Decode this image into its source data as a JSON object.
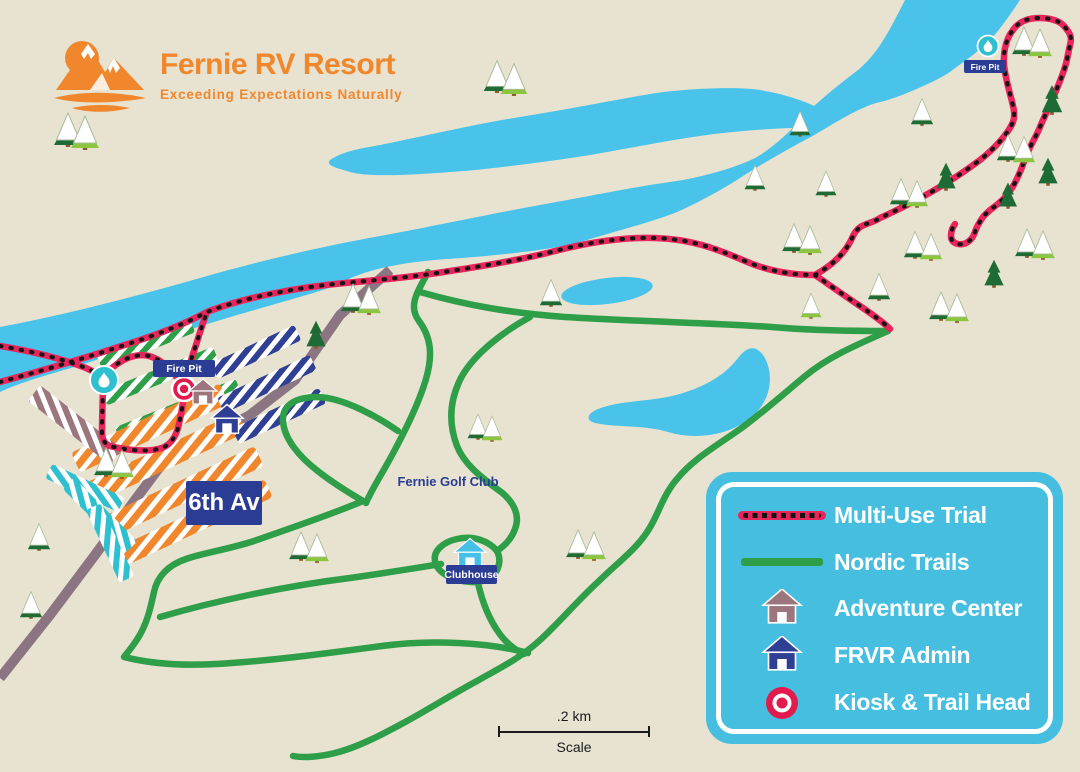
{
  "logo": {
    "title": "Fernie RV Resort",
    "tagline": "Exceeding Expectations Naturally"
  },
  "map_labels": {
    "fire_pit_left": "Fire Pit",
    "fire_pit_right": "Fire Pit",
    "street": "6th Av",
    "golf_club": "Fernie Golf Club",
    "clubhouse": "Clubhouse"
  },
  "scale_bar": {
    "distance": ".2 km",
    "label": "Scale"
  },
  "legend": {
    "items": [
      {
        "id": "multi-use-trail",
        "label": "Multi-Use Trial",
        "swatch": "dashed-line",
        "color": "#e8255b"
      },
      {
        "id": "nordic-trails",
        "label": "Nordic Trails",
        "swatch": "line",
        "color": "#2f9e48"
      },
      {
        "id": "adventure-center",
        "label": "Adventure Center",
        "swatch": "house",
        "color": "#9b777d"
      },
      {
        "id": "frvr-admin",
        "label": "FRVR Admin",
        "swatch": "house",
        "color": "#2e3f94"
      },
      {
        "id": "kiosk-trail-head",
        "label": "Kiosk & Trail Head",
        "swatch": "ring",
        "color": "#e31b4c"
      }
    ]
  },
  "colors": {
    "background": "#e8e2d0",
    "river": "#4ac3ea",
    "nordic_trail": "#2f9e48",
    "multi_use_trail": "#e8255b",
    "trail_dash": "#151515",
    "road": "#8b7583",
    "legend_panel": "#45bedf",
    "logo_orange": "#f0872c",
    "badge_blue": "#2b3c94",
    "teal": "#2fc0cf",
    "mauve": "#9b777d",
    "tree_dark": "#1e6b35",
    "tree_light": "#8cc63f"
  },
  "map": {
    "trees": [
      {
        "x": 68,
        "y": 146,
        "t": "sd",
        "s": 1
      },
      {
        "x": 85,
        "y": 149,
        "t": "sl",
        "s": 1
      },
      {
        "x": 497,
        "y": 92,
        "t": "sd",
        "s": 0.95
      },
      {
        "x": 514,
        "y": 95,
        "t": "sl",
        "s": 0.95
      },
      {
        "x": 1024,
        "y": 55,
        "t": "sd",
        "s": 0.85
      },
      {
        "x": 1040,
        "y": 57,
        "t": "sl",
        "s": 0.85
      },
      {
        "x": 1052,
        "y": 114,
        "t": "d",
        "s": 0.85
      },
      {
        "x": 800,
        "y": 136,
        "t": "sd",
        "s": 0.75
      },
      {
        "x": 922,
        "y": 125,
        "t": "sd",
        "s": 0.8
      },
      {
        "x": 755,
        "y": 190,
        "t": "sd",
        "s": 0.75
      },
      {
        "x": 826,
        "y": 196,
        "t": "sd",
        "s": 0.75
      },
      {
        "x": 901,
        "y": 205,
        "t": "sd",
        "s": 0.8
      },
      {
        "x": 917,
        "y": 207,
        "t": "sl",
        "s": 0.8
      },
      {
        "x": 946,
        "y": 190,
        "t": "d",
        "s": 0.8
      },
      {
        "x": 1008,
        "y": 161,
        "t": "sd",
        "s": 0.8
      },
      {
        "x": 1024,
        "y": 163,
        "t": "sl",
        "s": 0.8
      },
      {
        "x": 1048,
        "y": 185,
        "t": "d",
        "s": 0.8
      },
      {
        "x": 1008,
        "y": 208,
        "t": "d",
        "s": 0.75
      },
      {
        "x": 794,
        "y": 252,
        "t": "sd",
        "s": 0.85
      },
      {
        "x": 810,
        "y": 254,
        "t": "sl",
        "s": 0.85
      },
      {
        "x": 1027,
        "y": 257,
        "t": "sd",
        "s": 0.85
      },
      {
        "x": 1043,
        "y": 259,
        "t": "sl",
        "s": 0.85
      },
      {
        "x": 915,
        "y": 258,
        "t": "sd",
        "s": 0.8
      },
      {
        "x": 931,
        "y": 260,
        "t": "sl",
        "s": 0.8
      },
      {
        "x": 879,
        "y": 300,
        "t": "sd",
        "s": 0.8
      },
      {
        "x": 941,
        "y": 320,
        "t": "sd",
        "s": 0.85
      },
      {
        "x": 957,
        "y": 322,
        "t": "sl",
        "s": 0.85
      },
      {
        "x": 811,
        "y": 318,
        "t": "sl",
        "s": 0.75
      },
      {
        "x": 551,
        "y": 306,
        "t": "sd",
        "s": 0.8
      },
      {
        "x": 353,
        "y": 312,
        "t": "sd",
        "s": 0.85
      },
      {
        "x": 369,
        "y": 314,
        "t": "sl",
        "s": 0.85
      },
      {
        "x": 316,
        "y": 348,
        "t": "d",
        "s": 0.8
      },
      {
        "x": 478,
        "y": 439,
        "t": "sd",
        "s": 0.75
      },
      {
        "x": 492,
        "y": 441,
        "t": "sl",
        "s": 0.75
      },
      {
        "x": 106,
        "y": 476,
        "t": "sd",
        "s": 0.85
      },
      {
        "x": 122,
        "y": 478,
        "t": "sl",
        "s": 0.85
      },
      {
        "x": 39,
        "y": 550,
        "t": "sd",
        "s": 0.8
      },
      {
        "x": 31,
        "y": 618,
        "t": "sd",
        "s": 0.8
      },
      {
        "x": 301,
        "y": 560,
        "t": "sd",
        "s": 0.85
      },
      {
        "x": 317,
        "y": 562,
        "t": "sl",
        "s": 0.85
      },
      {
        "x": 578,
        "y": 558,
        "t": "sd",
        "s": 0.85
      },
      {
        "x": 594,
        "y": 560,
        "t": "sl",
        "s": 0.85
      },
      {
        "x": 994,
        "y": 287,
        "t": "d",
        "s": 0.8
      }
    ]
  }
}
